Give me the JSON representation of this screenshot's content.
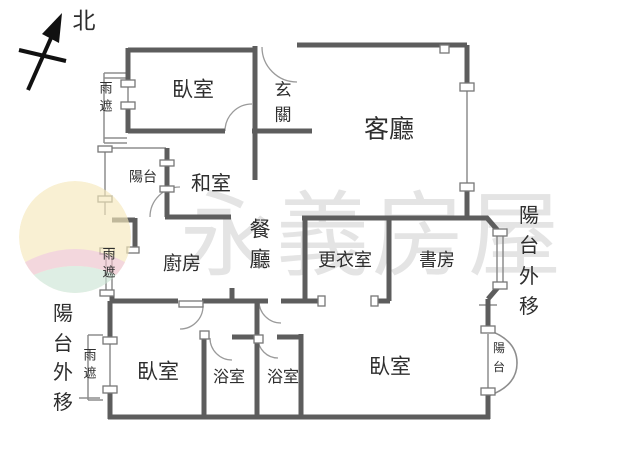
{
  "compass": {
    "north_label": "北"
  },
  "watermark": {
    "brand_text": "永義房屋"
  },
  "rooms": {
    "bedroom_top": "臥室",
    "foyer": "玄關",
    "living": "客廳",
    "balcony_small": "陽台",
    "tatami": "和室",
    "dining": "餐廳",
    "kitchen": "廚房",
    "closet": "更衣室",
    "study": "書房",
    "bedroom_left": "臥室",
    "bath1": "浴室",
    "bath2": "浴室",
    "bedroom_right": "臥室",
    "balcony_curved": "陽台"
  },
  "annotations": {
    "rain_top": "雨遮",
    "rain_mid": "雨遮",
    "rain_bottom": "雨遮",
    "balcony_ext_left": "陽台外移",
    "balcony_ext_right": "陽台外移"
  },
  "colors": {
    "wall": "#5d5d5d",
    "thin_line": "#8d8d8d",
    "label_text": "#2e2e2e",
    "watermark_text": "#e4e4e4",
    "logo_yellow": "#f6e9bd",
    "logo_pink": "#eec3cc",
    "logo_green": "#cde6d6"
  }
}
